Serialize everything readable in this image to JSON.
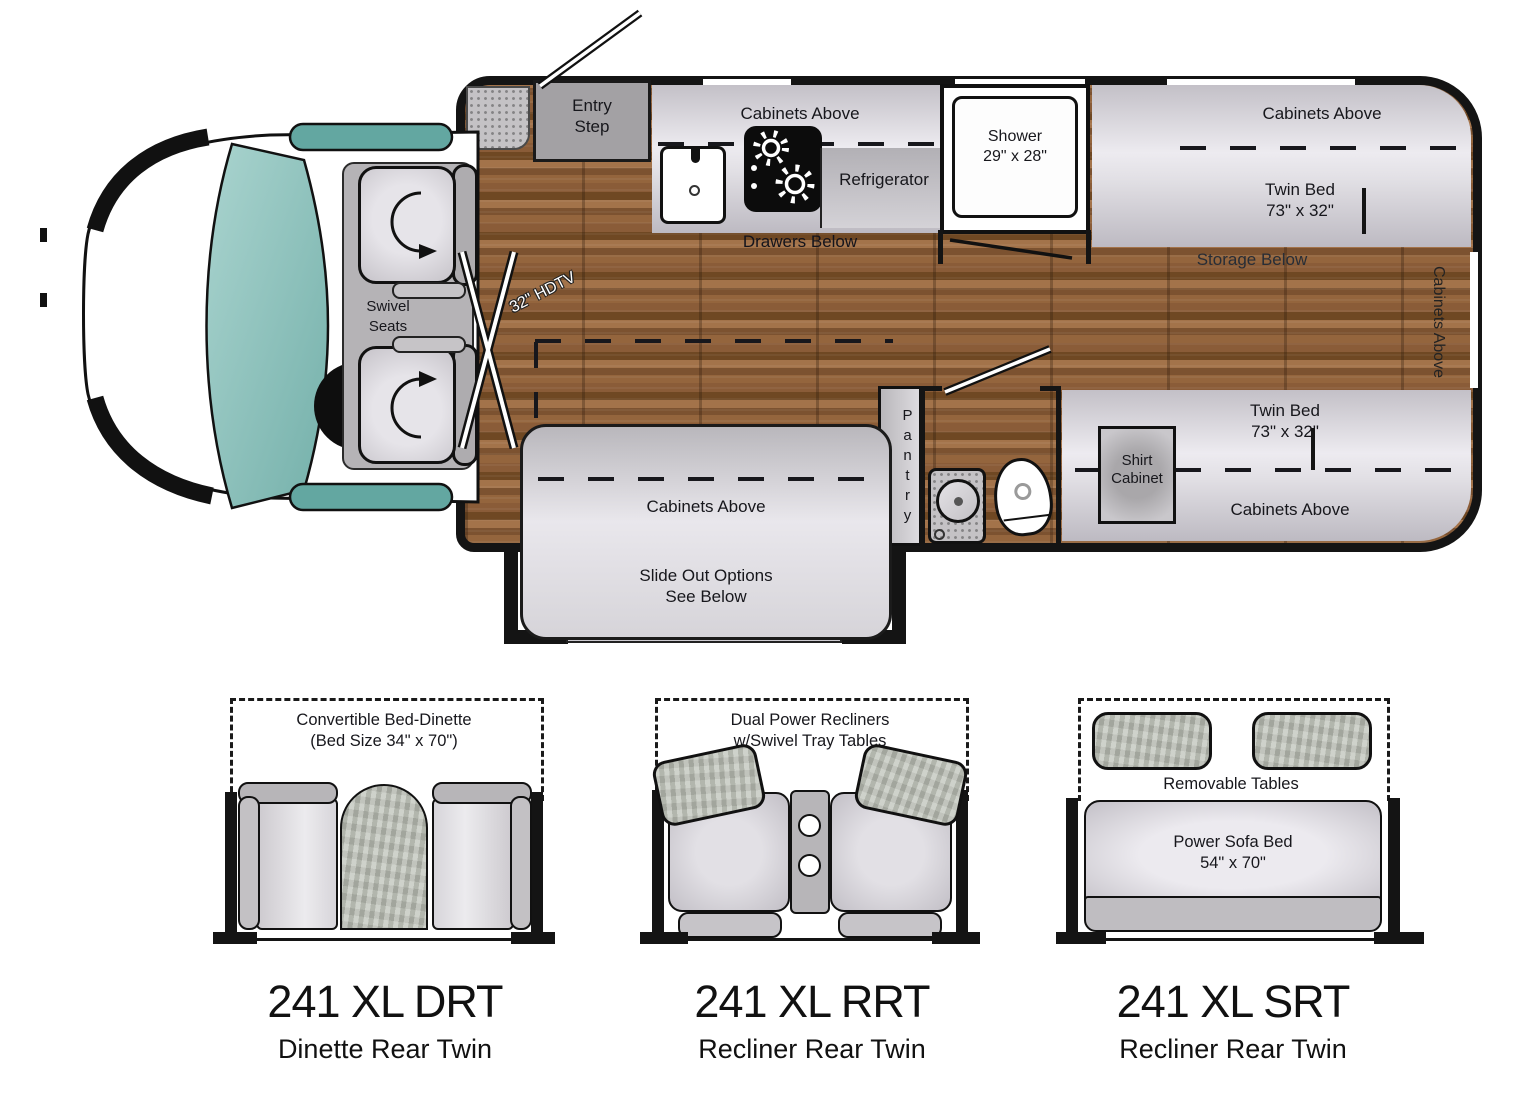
{
  "plan": {
    "entry_step": {
      "l1": "Entry",
      "l2": "Step"
    },
    "swivel_seats": {
      "l1": "Swivel",
      "l2": "Seats"
    },
    "hdtv": "32\" HDTV",
    "kitchen": {
      "cabinets_above": "Cabinets Above",
      "refrigerator": "Refrigerator",
      "drawers_below": "Drawers Below"
    },
    "shower": {
      "l1": "Shower",
      "l2": "29\" x 28\""
    },
    "shirt_cabinet": {
      "l1": "Shirt",
      "l2": "Cabinet"
    },
    "bed_top": {
      "cabinets_above": "Cabinets Above",
      "bed_l1": "Twin Bed",
      "bed_l2": "73\" x 32\"",
      "storage_below": "Storage Below"
    },
    "rear_cabinets_above": "Cabinets Above",
    "bed_bottom": {
      "bed_l1": "Twin Bed",
      "bed_l2": "73\" x 32\"",
      "cabinets_above": "Cabinets Above"
    },
    "pantry": "Pantry",
    "slideout": {
      "cabinets_above": "Cabinets Above",
      "l1": "Slide Out Options",
      "l2": "See Below"
    }
  },
  "options": [
    {
      "model": "241 XL DRT",
      "name": "Dinette Rear Twin",
      "note_l1": "Convertible Bed-Dinette",
      "note_l2": "(Bed Size 34\" x 70\")"
    },
    {
      "model": "241 XL RRT",
      "name": "Recliner Rear Twin",
      "note_l1": "Dual Power Recliners",
      "note_l2": "w/Swivel Tray Tables"
    },
    {
      "model": "241 XL SRT",
      "name": "Recliner Rear Twin",
      "note_l1": "Removable Tables",
      "sofa_l1": "Power Sofa Bed",
      "sofa_l2": "54\" x 70\""
    }
  ],
  "colors": {
    "wood": "#8a5c38",
    "glass_teal": "#8fc3bd",
    "furniture_light": "#e8e6eb",
    "furniture_mid": "#b6b4b7",
    "wall_black": "#141414",
    "table_texture": "#b9bdb3"
  }
}
